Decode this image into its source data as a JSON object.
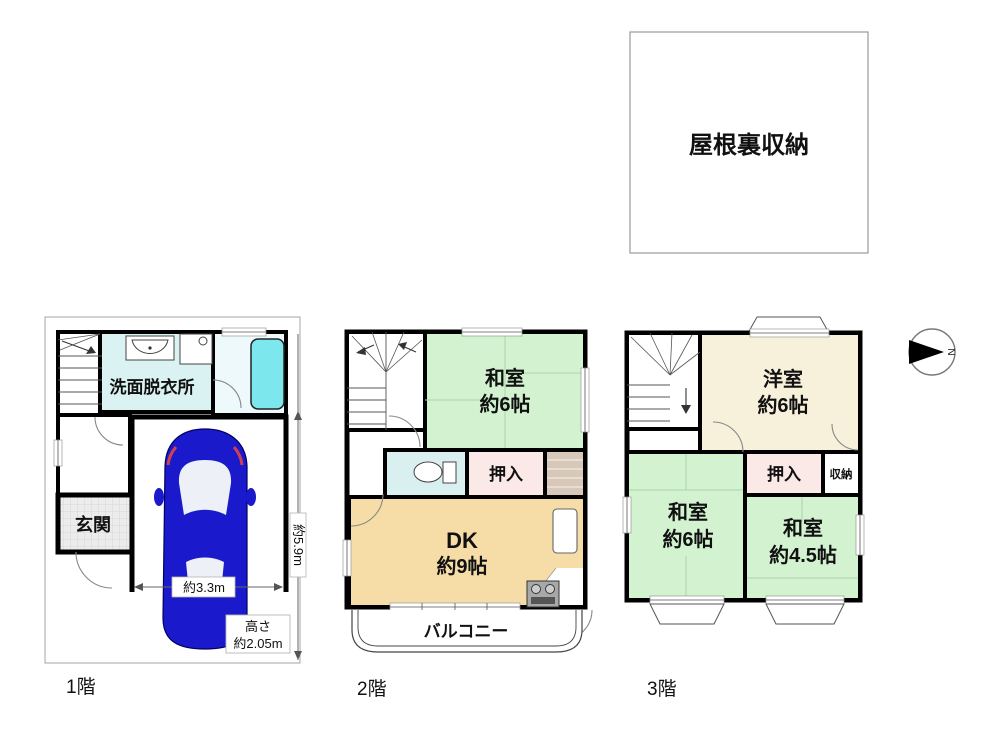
{
  "attic": {
    "label": "屋根裏収納"
  },
  "floors": {
    "f1": {
      "caption": "1階",
      "washroom_label": "洗面脱衣所",
      "entrance_label": "玄関",
      "dim_width": "約3.3m",
      "dim_height": "約5.9m",
      "clearance_line1": "高さ",
      "clearance_line2": "約2.05m"
    },
    "f2": {
      "caption": "2階",
      "washitsu_line1": "和室",
      "washitsu_line2": "約6帖",
      "oshiire_label": "押入",
      "dk_line1": "DK",
      "dk_line2": "約9帖",
      "balcony_label": "バルコニー"
    },
    "f3": {
      "caption": "3階",
      "yoshitsu_line1": "洋室",
      "yoshitsu_line2": "約6帖",
      "oshiire_label": "押入",
      "shunou_label": "収納",
      "washitsu6_line1": "和室",
      "washitsu6_line2": "約6帖",
      "washitsu45_line1": "和室",
      "washitsu45_line2": "約4.5帖"
    }
  },
  "compass": {
    "label": "N"
  },
  "colors": {
    "wall": "#000000",
    "washitsu_green": "#d2f2d0",
    "yoshitsu_cream": "#f7f0da",
    "dk_tan": "#f6dca6",
    "closet_pink": "#fbe9e7",
    "washroom_cyan": "#daf2f2",
    "toilet_cyan": "#daf0f0",
    "bathtub_cyan": "#7ce8ee",
    "bath_floor": "#eef9fb",
    "car_blue": "#1a1acc",
    "stair_strip": "#d8c8ba",
    "site_border": "#a6a6a6"
  }
}
